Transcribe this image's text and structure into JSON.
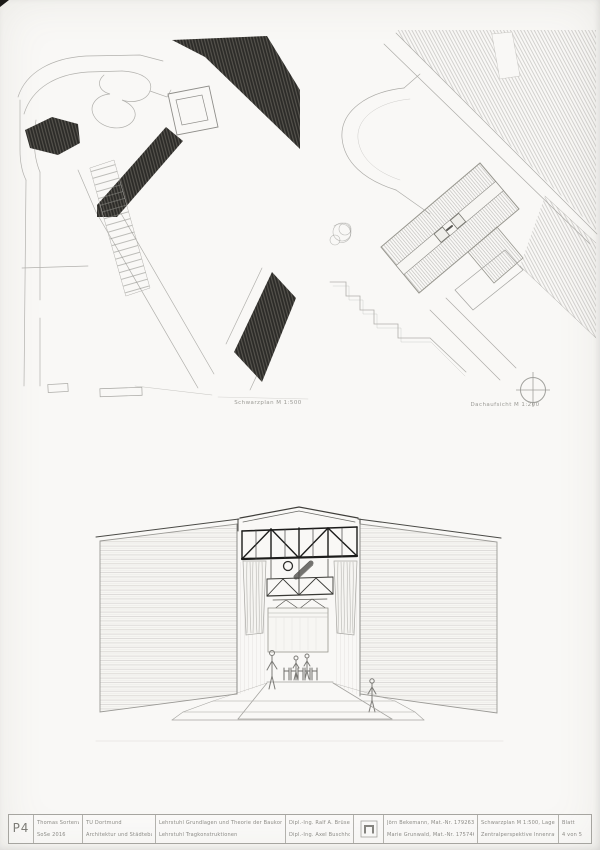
{
  "captions": {
    "left_plan": "Schwarzplan M 1:500",
    "right_plan": "Dachaufsicht M 1:200"
  },
  "title_block": {
    "sheet_code": "P4",
    "project": {
      "line1": "Thomas Sortenwald",
      "line2": "SoSe 2016"
    },
    "university": {
      "line1": "TU Dortmund",
      "line2": "Architektur und Städtebau"
    },
    "chairs": {
      "line1": "Lehrstuhl Grundlagen und Theorie der Baukonstruktion",
      "line2": "Lehrstuhl Tragkonstruktionen"
    },
    "tutors": {
      "line1": "Dipl.-Ing. Ralf A. Brüse",
      "line2": "Dipl.-Ing. Axel Buschhorst"
    },
    "students": {
      "line1": "Jörn Bekemann, Mat.-Nr. 179263",
      "line2": "Marie Grunwald, Mat.-Nr. 175746"
    },
    "contents": {
      "line1": "Schwarzplan M 1:500, Lageplan M 1:200",
      "line2": "Zentralperspektive Innenraum"
    },
    "sheet": {
      "label": "Blatt",
      "number": "4 von 5"
    }
  },
  "icons": {
    "north_arrow": "circle with cross (north symbol)",
    "chair_logo": "pi-shaped mark in square"
  },
  "colors": {
    "paper": "#f9f8f6",
    "pencil_light": "#b2b1ad",
    "pencil_mid": "#8f8e8a",
    "pencil_dark": "#2c2b28",
    "truss_black": "#1c1c1b"
  }
}
